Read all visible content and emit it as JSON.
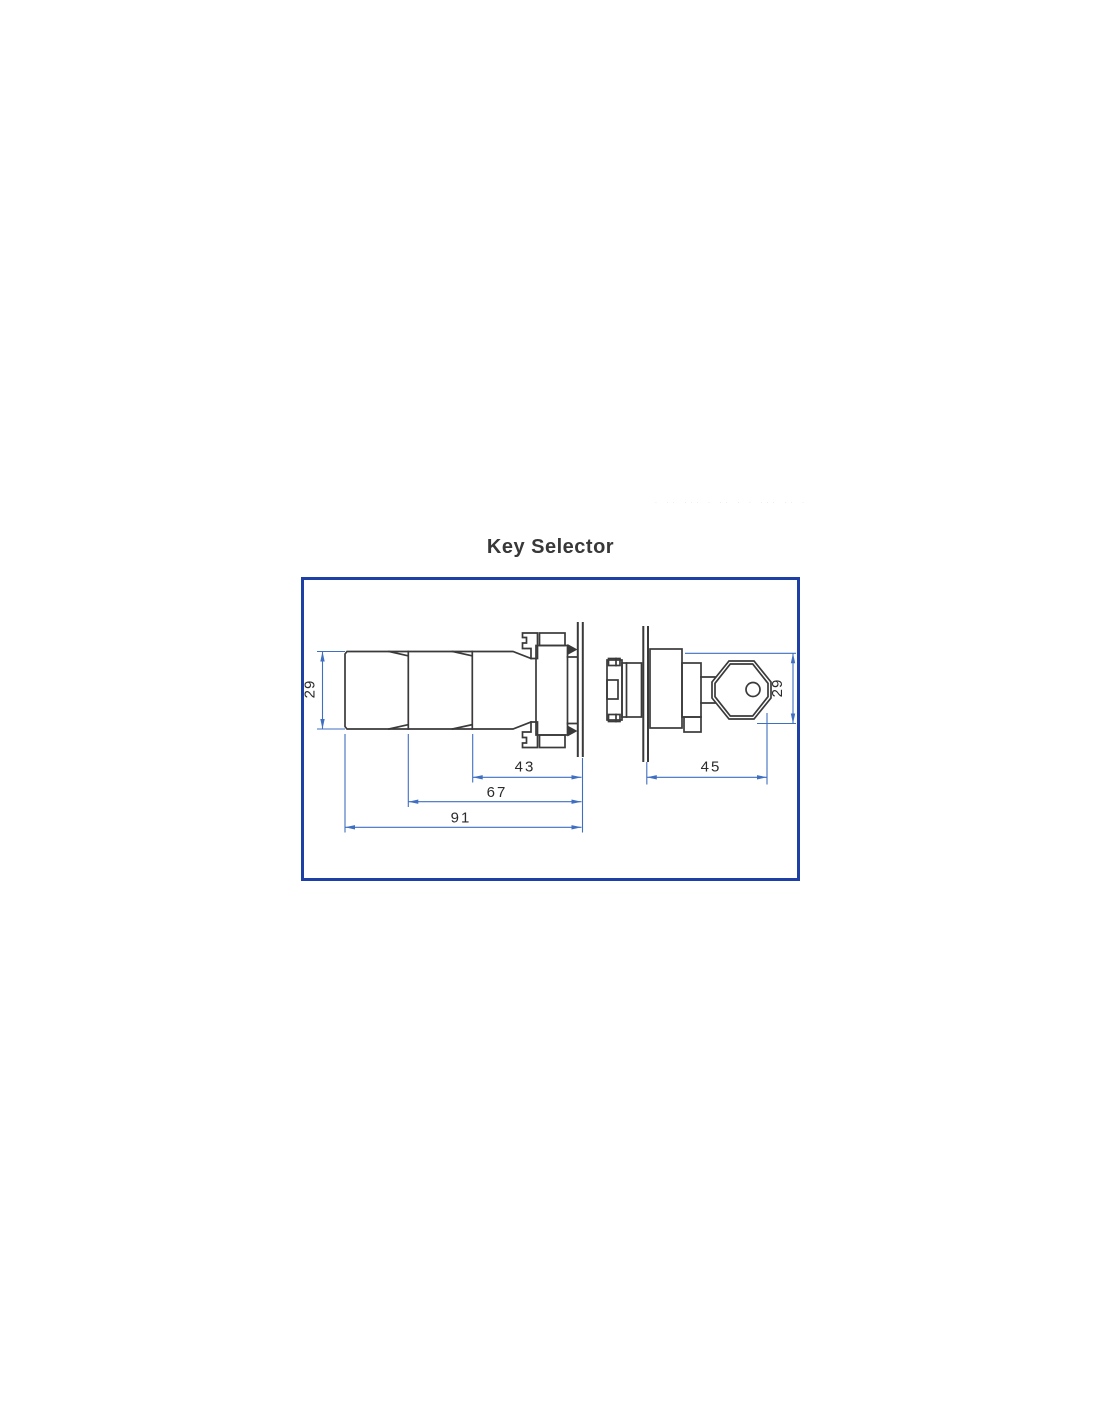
{
  "title": "Key Selector",
  "artifact_marks": "· ·· ··· · ·· · · ··· ·· ·",
  "colors": {
    "frame_border": "#1d3fa6",
    "dimension_lines": "#3f6fc1",
    "drawing_lines": "#3a3a3a",
    "label_text": "#2b2b2b"
  },
  "drawing": {
    "dimensions": {
      "body_height_left": "29",
      "body_height_right": "29",
      "length_front": "43",
      "length_mid": "67",
      "length_overall": "91",
      "length_key_side": "45"
    }
  }
}
